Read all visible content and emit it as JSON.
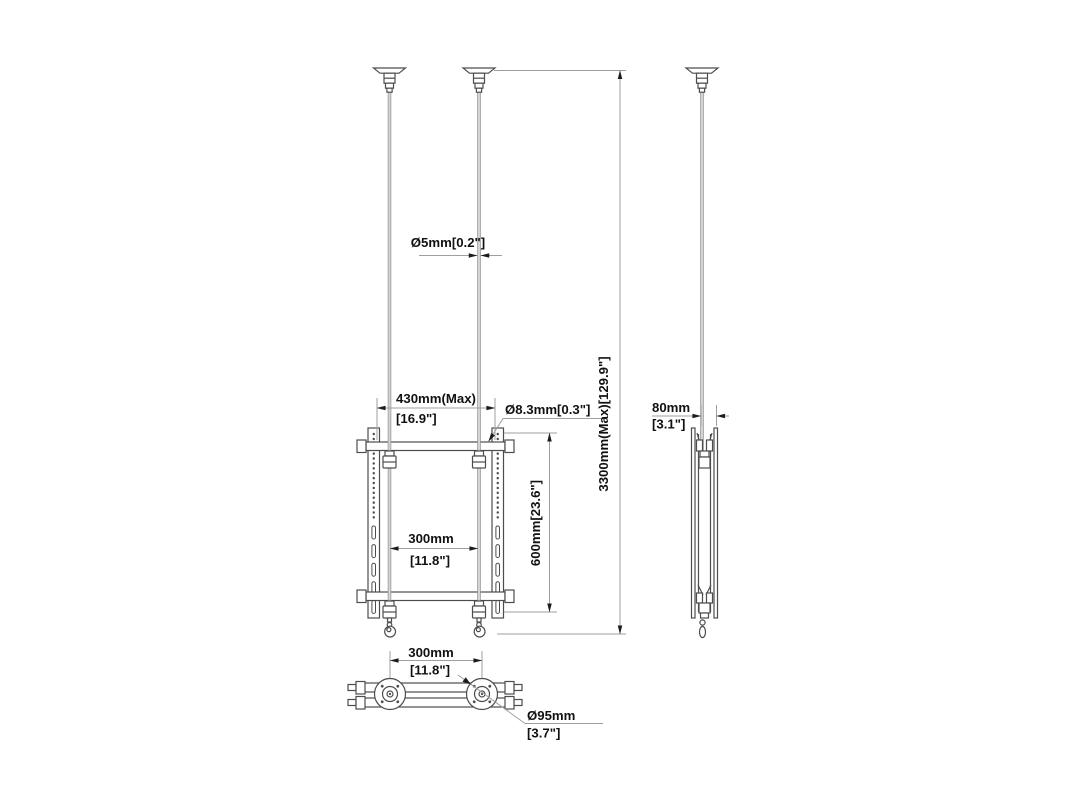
{
  "drawing": {
    "type": "technical-dimension-drawing",
    "views": [
      "front",
      "side",
      "bottom"
    ],
    "colors": {
      "line": "#4d4d4d",
      "dimension_line": "#9f9f9f",
      "wire": "#d4d4d4",
      "background": "#ffffff",
      "text": "#111111"
    },
    "annotations": {
      "cable_diameter": "Ø5mm[0.2\"]",
      "max_width_mm": "430mm(Max)",
      "max_width_in": "[16.9\"]",
      "hole_diameter": "Ø8.3mm[0.3\"]",
      "inner_width_mm": "300mm",
      "inner_width_in": "[11.8\"]",
      "bracket_height": "600mm[23.6\"]",
      "max_drop": "3300mm(Max)[129.9\"]",
      "profile_depth_mm": "80mm",
      "profile_depth_in": "[3.1\"]",
      "bottom_spacing_mm": "300mm",
      "bottom_spacing_in": "[11.8\"]",
      "flange_diameter_mm": "Ø95mm",
      "flange_diameter_in": "[3.7\"]"
    }
  }
}
